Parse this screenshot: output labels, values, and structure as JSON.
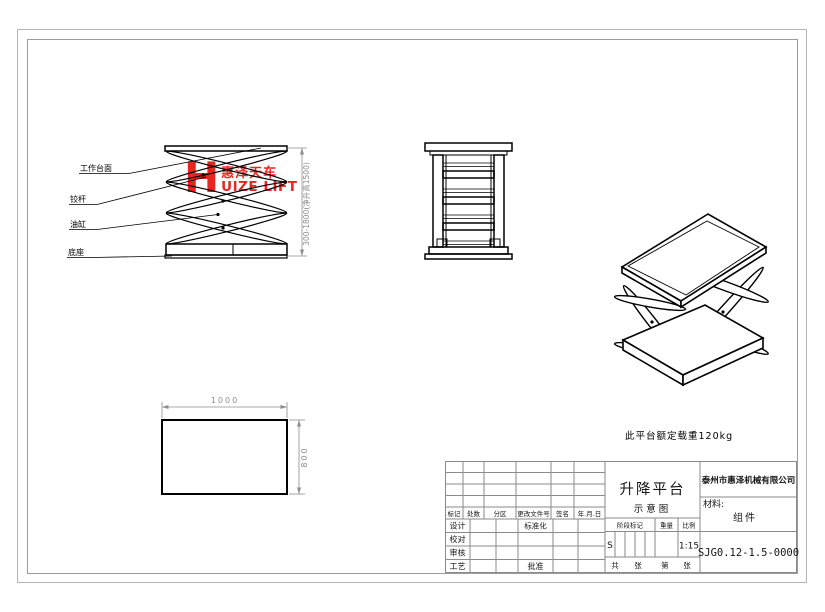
{
  "watermark": {
    "h": "H",
    "cn": "惠泽天车",
    "en": "UIZE LIFT",
    "color": "#e8251f"
  },
  "front_view": {
    "labels": [
      "工作台面",
      "铰杆",
      "油缸",
      "底座"
    ],
    "height_dim": "300-1800(净升高1500)"
  },
  "plan_view": {
    "width_dim": "1000",
    "height_dim": "800"
  },
  "note": "此平台额定载重120kg",
  "title_block": {
    "company": "泰州市惠泽机械有限公司",
    "drawing_title": "升降平台",
    "drawing_subtitle": "示意图",
    "material_label": "材料:",
    "material_value": "组件",
    "drawing_number": "SJG0.12-1.5-0000",
    "stage_label": "阶段标记",
    "weight_label": "重量",
    "scale_label": "比例",
    "stage_value": "S",
    "scale_value": "1:15",
    "sheet_labels": [
      "共",
      "张",
      "第",
      "张"
    ],
    "rev_headers": [
      "标记",
      "处数",
      "分区",
      "更改文件号",
      "签名",
      "年.月.日"
    ],
    "sig_labels": [
      "设计",
      "校对",
      "审核",
      "工艺"
    ],
    "std_label": "标准化",
    "approve_label": "批准"
  },
  "colors": {
    "logo_red": "#e8251f",
    "drawing_black": "#000000",
    "dim_gray": "#8c8c8c",
    "border_gray": "#9b9b9b"
  }
}
